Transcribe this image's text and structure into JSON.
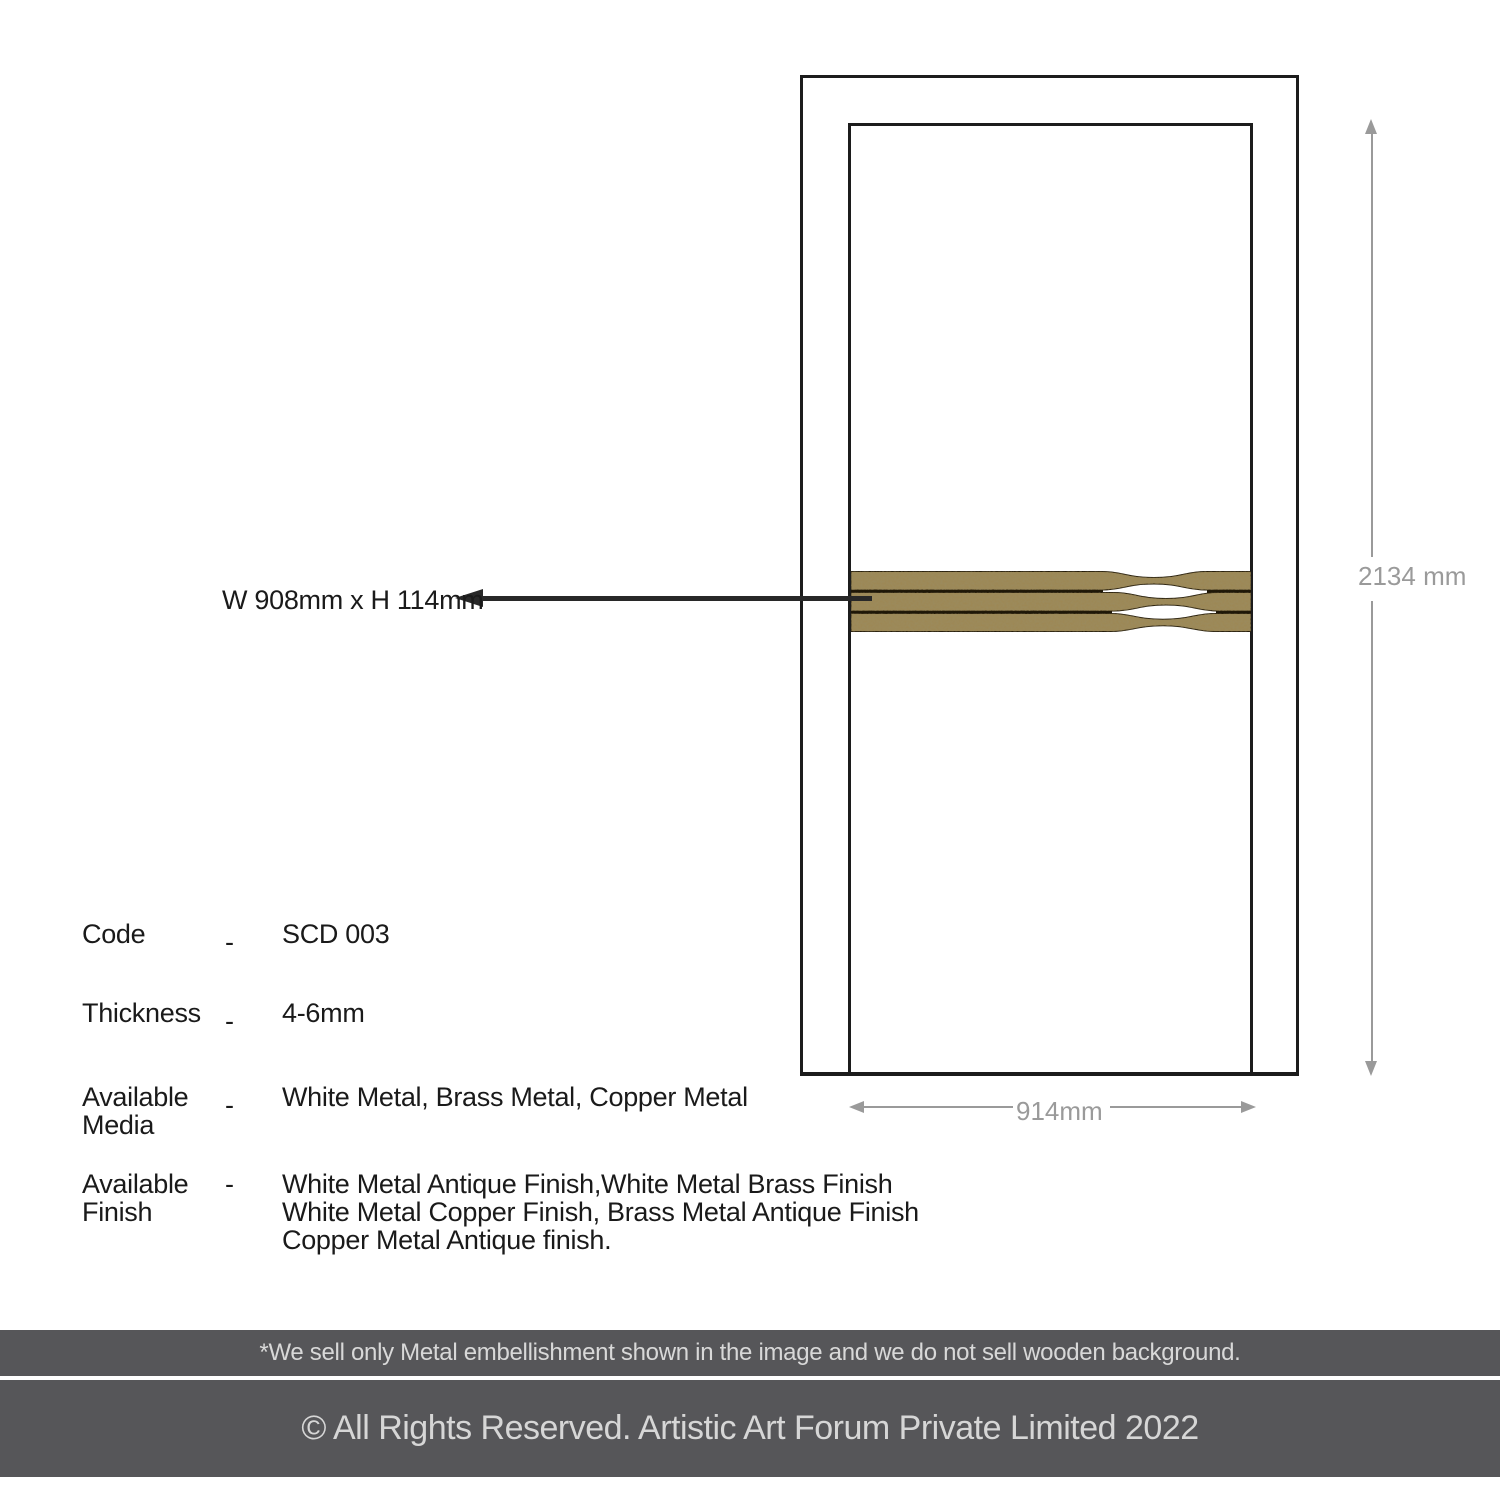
{
  "diagram": {
    "callout_label": "W 908mm x H 114mm",
    "dim_height_label": "2134 mm",
    "dim_width_label": "914mm"
  },
  "specs": {
    "code": {
      "label": "Code",
      "dash": "-",
      "value": "SCD 003"
    },
    "thickness": {
      "label": "Thickness",
      "dash": "-",
      "value": "4-6mm"
    },
    "media": {
      "label_line1": "Available",
      "label_line2": "Media",
      "dash": "-",
      "value": "White Metal, Brass Metal, Copper Metal"
    },
    "finish": {
      "label_line1": "Available",
      "label_line2": "Finish",
      "dash": "-",
      "value_line1": "White Metal Antique Finish,White Metal Brass Finish",
      "value_line2": "White Metal Copper Finish, Brass Metal Antique Finish",
      "value_line3": "Copper Metal Antique finish."
    }
  },
  "footer": {
    "note": "*We sell only Metal embellishment shown in the image and we do not sell wooden background.",
    "copyright": "© All Rights Reserved. Artistic Art Forum Private Limited 2022"
  },
  "icons": {
    "callout_arrow": "arrow-left-icon",
    "dim_arrows": [
      "arrow-up-icon",
      "arrow-down-icon",
      "arrow-left-icon",
      "arrow-right-icon"
    ]
  },
  "colors": {
    "ink": "#1a1a1a",
    "dimension_gray": "#9a9a9a",
    "bar_gray": "#565659",
    "bar_text": "#d8d8d8",
    "brass": "#9d8855",
    "strip_gap": "#1e1708",
    "strip_outline": "#241b09"
  }
}
